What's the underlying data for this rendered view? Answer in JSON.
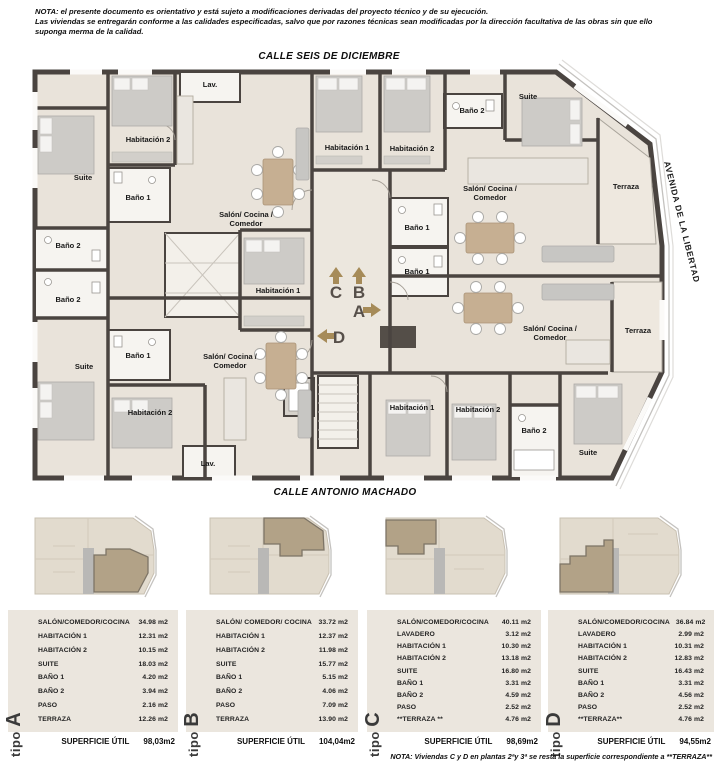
{
  "header_note": {
    "line1": "NOTA:  el presente documento es orientativo y está sujeto a modificaciones derivadas del proyecto técnico y de su ejecución.",
    "line2": "Las viviendas se entregarán conforme a las calidades especificadas, salvo que por razones técnicas sean modificadas por la dirección facultativa de las obras sin que ello",
    "line3": "suponga merma de la calidad."
  },
  "streets": {
    "top": "CALLE SEIS DE DICIEMBRE",
    "bottom": "CALLE ANTONIO MACHADO",
    "right": "AVENIDA DE LA LIBERTAD"
  },
  "plan": {
    "shared_labels": {
      "salon_line1": "Salón/ Cocina /",
      "salon_line2": "Comedor",
      "lav": "Lav.",
      "hab1": "Habitación 1",
      "hab2": "Habitación 2",
      "suite": "Suite",
      "bano1": "Baño 1",
      "bano2": "Baño 2",
      "terraza": "Terraza"
    },
    "unit_markers": {
      "a": "A",
      "b": "B",
      "c": "C",
      "d": "D"
    }
  },
  "palette": {
    "wall": "#4a4440",
    "floor": "#e9e3da",
    "thumb_base": "#e2dbce",
    "thumb_highlight": "#b2a287",
    "arrow": "#a68b58",
    "table_panel": "#ebe6de"
  },
  "types": [
    {
      "id": "A",
      "tipo_word": "tipo",
      "letter": "A",
      "rows": [
        {
          "name": "SALÓN/COMEDOR/COCINA",
          "value": "34.98 m2"
        },
        {
          "name": "HABITACIÓN 1",
          "value": "12.31 m2"
        },
        {
          "name": "HABITACIÓN 2",
          "value": "10.15 m2"
        },
        {
          "name": "SUITE",
          "value": "18.03 m2"
        },
        {
          "name": "BAÑO 1",
          "value": "4.20 m2"
        },
        {
          "name": "BAÑO 2",
          "value": "3.94 m2"
        },
        {
          "name": "PASO",
          "value": "2.16 m2"
        },
        {
          "name": "TERRAZA",
          "value": "12.26 m2"
        }
      ],
      "total_label": "SUPERFICIE ÚTIL",
      "total_value": "98,03m2"
    },
    {
      "id": "B",
      "tipo_word": "tipo",
      "letter": "B",
      "rows": [
        {
          "name": "SALÓN/ COMEDOR/ COCINA",
          "value": "33.72 m2"
        },
        {
          "name": "HABITACIÓN 1",
          "value": "12.37 m2"
        },
        {
          "name": "HABITACIÓN 2",
          "value": "11.98 m2"
        },
        {
          "name": "SUITE",
          "value": "15.77 m2"
        },
        {
          "name": "BAÑO 1",
          "value": "5.15 m2"
        },
        {
          "name": "BAÑO 2",
          "value": "4.06 m2"
        },
        {
          "name": "PASO",
          "value": "7.09 m2"
        },
        {
          "name": "TERRAZA",
          "value": "13.90 m2"
        }
      ],
      "total_label": "SUPERFICIE ÚTIL",
      "total_value": "104,04m2"
    },
    {
      "id": "C",
      "tipo_word": "tipo",
      "letter": "C",
      "rows": [
        {
          "name": "SALÓN/COMEDOR/COCINA",
          "value": "40.11 m2"
        },
        {
          "name": "LAVADERO",
          "value": "3.12 m2"
        },
        {
          "name": "HABITACIÓN 1",
          "value": "10.30 m2"
        },
        {
          "name": "HABITACIÓN 2",
          "value": "13.18 m2"
        },
        {
          "name": "SUITE",
          "value": "16.80 m2"
        },
        {
          "name": "BAÑO 1",
          "value": "3.31 m2"
        },
        {
          "name": "BAÑO 2",
          "value": "4.59 m2"
        },
        {
          "name": "PASO",
          "value": "2.52 m2"
        },
        {
          "name": "**TERRAZA **",
          "value": "4.76 m2"
        }
      ],
      "total_label": "SUPERFICIE ÚTIL",
      "total_value": "98,69m2"
    },
    {
      "id": "D",
      "tipo_word": "tipo",
      "letter": "D",
      "rows": [
        {
          "name": "SALÓN/COMEDOR/COCINA",
          "value": "36.84 m2"
        },
        {
          "name": "LAVADERO",
          "value": "2.99 m2"
        },
        {
          "name": "HABITACIÓN 1",
          "value": "10.31 m2"
        },
        {
          "name": "HABITACIÓN 2",
          "value": "12.83 m2"
        },
        {
          "name": "SUITE",
          "value": "16.43 m2"
        },
        {
          "name": "BAÑO 1",
          "value": "3.31 m2"
        },
        {
          "name": "BAÑO 2",
          "value": "4.56 m2"
        },
        {
          "name": "PASO",
          "value": "2.52 m2"
        },
        {
          "name": "**TERRAZA**",
          "value": "4.76 m2"
        }
      ],
      "total_label": "SUPERFICIE ÚTIL",
      "total_value": "94,55m2"
    }
  ],
  "footer_note": "NOTA: Viviendas C y D en plantas 2ªy 3ª se resta la superficie correspondiente a **TERRAZA**"
}
